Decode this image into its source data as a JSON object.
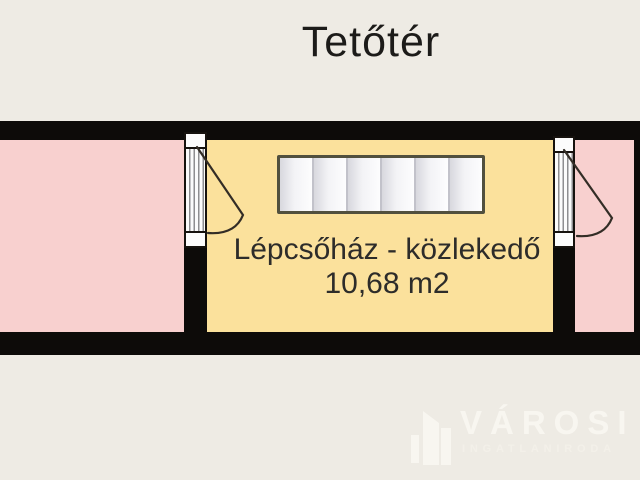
{
  "floorplan": {
    "title": "Tetőtér",
    "room_label": {
      "line1": "Lépcsőház - közlekedő",
      "line2": "10,68 m2"
    },
    "rooms": [
      {
        "id": "left-room",
        "fill": "#f8d0cf"
      },
      {
        "id": "staircase-room",
        "fill": "#fbe19c",
        "name": "Lépcsőház - közlekedő",
        "area_m2": "10,68"
      },
      {
        "id": "right-room",
        "fill": "#f8d0cf"
      }
    ],
    "stairs": {
      "treads": 6
    },
    "colors": {
      "background": "#eeebe4",
      "wall": "#0d0b09",
      "stair_fill": "#f4f4f6",
      "stair_border": "#51503e",
      "title_text": "#1c1b19",
      "label_text": "#2d2c2a"
    }
  },
  "watermark": {
    "brand": "VÁROSI",
    "tagline": "INGATLANIRODA",
    "color": "#f8f6f0"
  }
}
